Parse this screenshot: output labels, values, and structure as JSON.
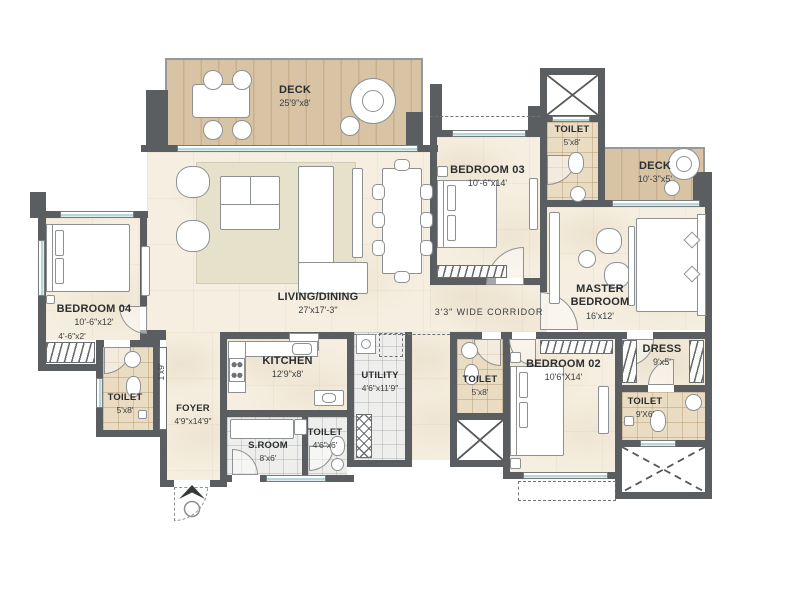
{
  "rooms": {
    "deck_main": {
      "name": "DECK",
      "dims": "25'9\"x8'"
    },
    "living_dining": {
      "name": "LIVING/DINING",
      "dims": "27'x17'-3\""
    },
    "bedroom_03": {
      "name": "BEDROOM 03",
      "dims": "10'-6\"x14'"
    },
    "toilet_top": {
      "name": "TOILET",
      "dims": "5'x8'"
    },
    "deck_right": {
      "name": "DECK",
      "dims": "10'-3\"x5'"
    },
    "master_bedroom": {
      "name": "MASTER BEDROOM",
      "dims": "16'x12'"
    },
    "dress": {
      "name": "DRESS",
      "dims": "9'x5'"
    },
    "toilet_master": {
      "name": "TOILET",
      "dims": "9'X6'"
    },
    "bedroom_02": {
      "name": "BEDROOM 02",
      "dims": "10'6\"X14'"
    },
    "toilet_bed02": {
      "name": "TOILET",
      "dims": "5'x8'"
    },
    "kitchen": {
      "name": "KITCHEN",
      "dims": "12'9\"x8'"
    },
    "utility": {
      "name": "UTILITY",
      "dims": "4'6\"x11'9\""
    },
    "bedroom_04": {
      "name": "BEDROOM 04",
      "dims": "10'-6\"x12'"
    },
    "toilet_bed04": {
      "name": "TOILET",
      "dims": "5'x8'"
    },
    "foyer": {
      "name": "FOYER",
      "dims": "4'9\"x14'9\""
    },
    "servant_room": {
      "name": "S.ROOM",
      "dims": "8'x6'"
    },
    "toilet_sroom": {
      "name": "TOILET",
      "dims": "4'6\"x6'"
    }
  },
  "corridor_label": "3'3\" WIDE CORRIDOR",
  "bedroom_04_wardrobe_dims": "4'-6\"x2'",
  "ledge_dims": "1'x9'",
  "colors": {
    "wall": "#5a5e60",
    "marble_floor": "#f6efe1",
    "deck_wood": "#d9c3a5",
    "bath_tile": "#e9dcc3",
    "grey_tile": "#eeeeec",
    "window_glass": "#b7d6d8",
    "text": "#2b2e30"
  }
}
